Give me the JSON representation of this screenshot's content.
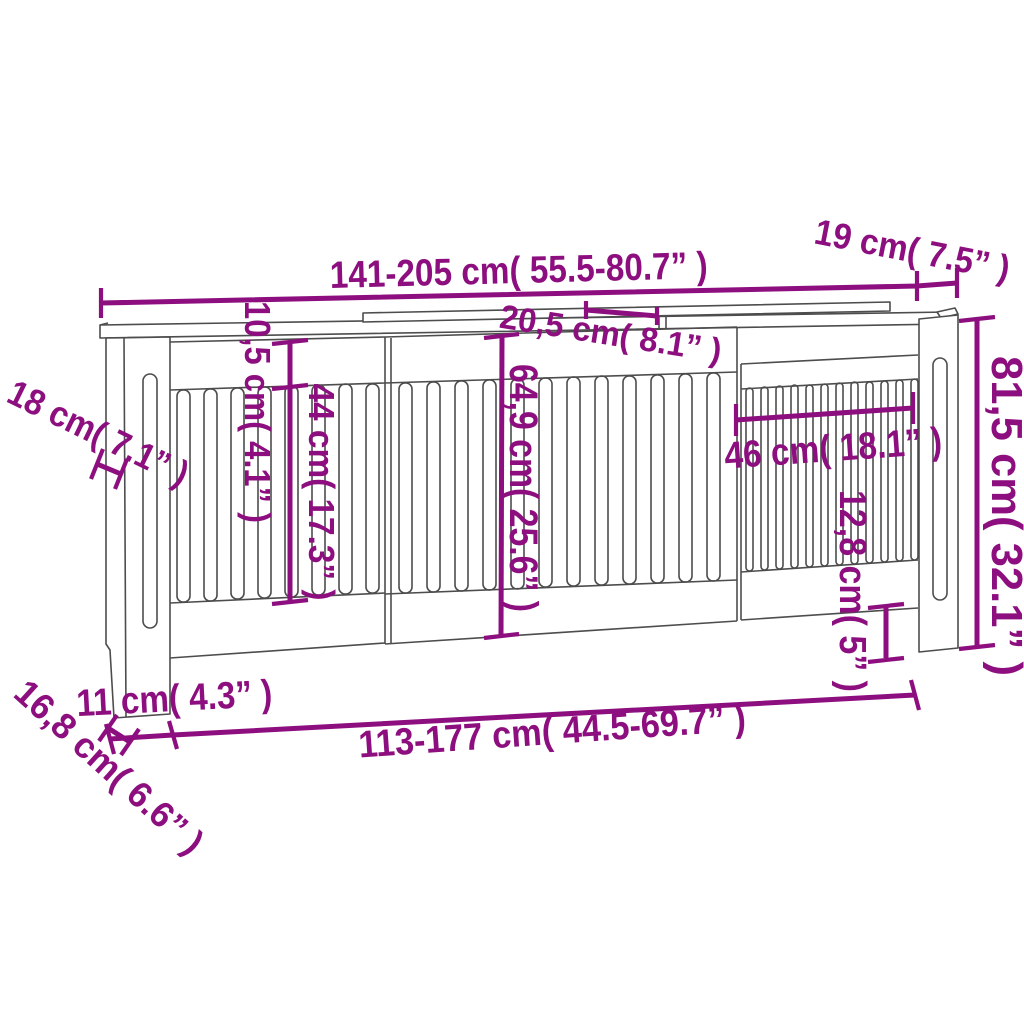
{
  "diagram": {
    "type": "product-dimension-diagram",
    "accent_color": "#8d0f7f",
    "line_color": "#4d4d4d",
    "dimensions": {
      "width_range": "141-205 cm( 55.5-80.7” )",
      "shelf_depth": "19 cm( 7.5” )",
      "extension_overlap": "20,5 cm( 8.1” )",
      "side_depth": "18 cm( 7.1” )",
      "top_rail_height": "10,5 cm( 4.1” )",
      "left_slat_height": "44 cm( 17.3” )",
      "inner_height": "64,9 cm( 25.6” )",
      "extension_panel_width": "46 cm( 18.1” )",
      "bottom_right_height": "12,8 cm( 5” )",
      "total_height": "81,5 cm( 32.1” )",
      "leg_width": "11 cm( 4.3” )",
      "inner_width_range": "113-177 cm( 44.5-69.7” )",
      "leg_depth": "16,8 cm( 6.6” )"
    }
  }
}
